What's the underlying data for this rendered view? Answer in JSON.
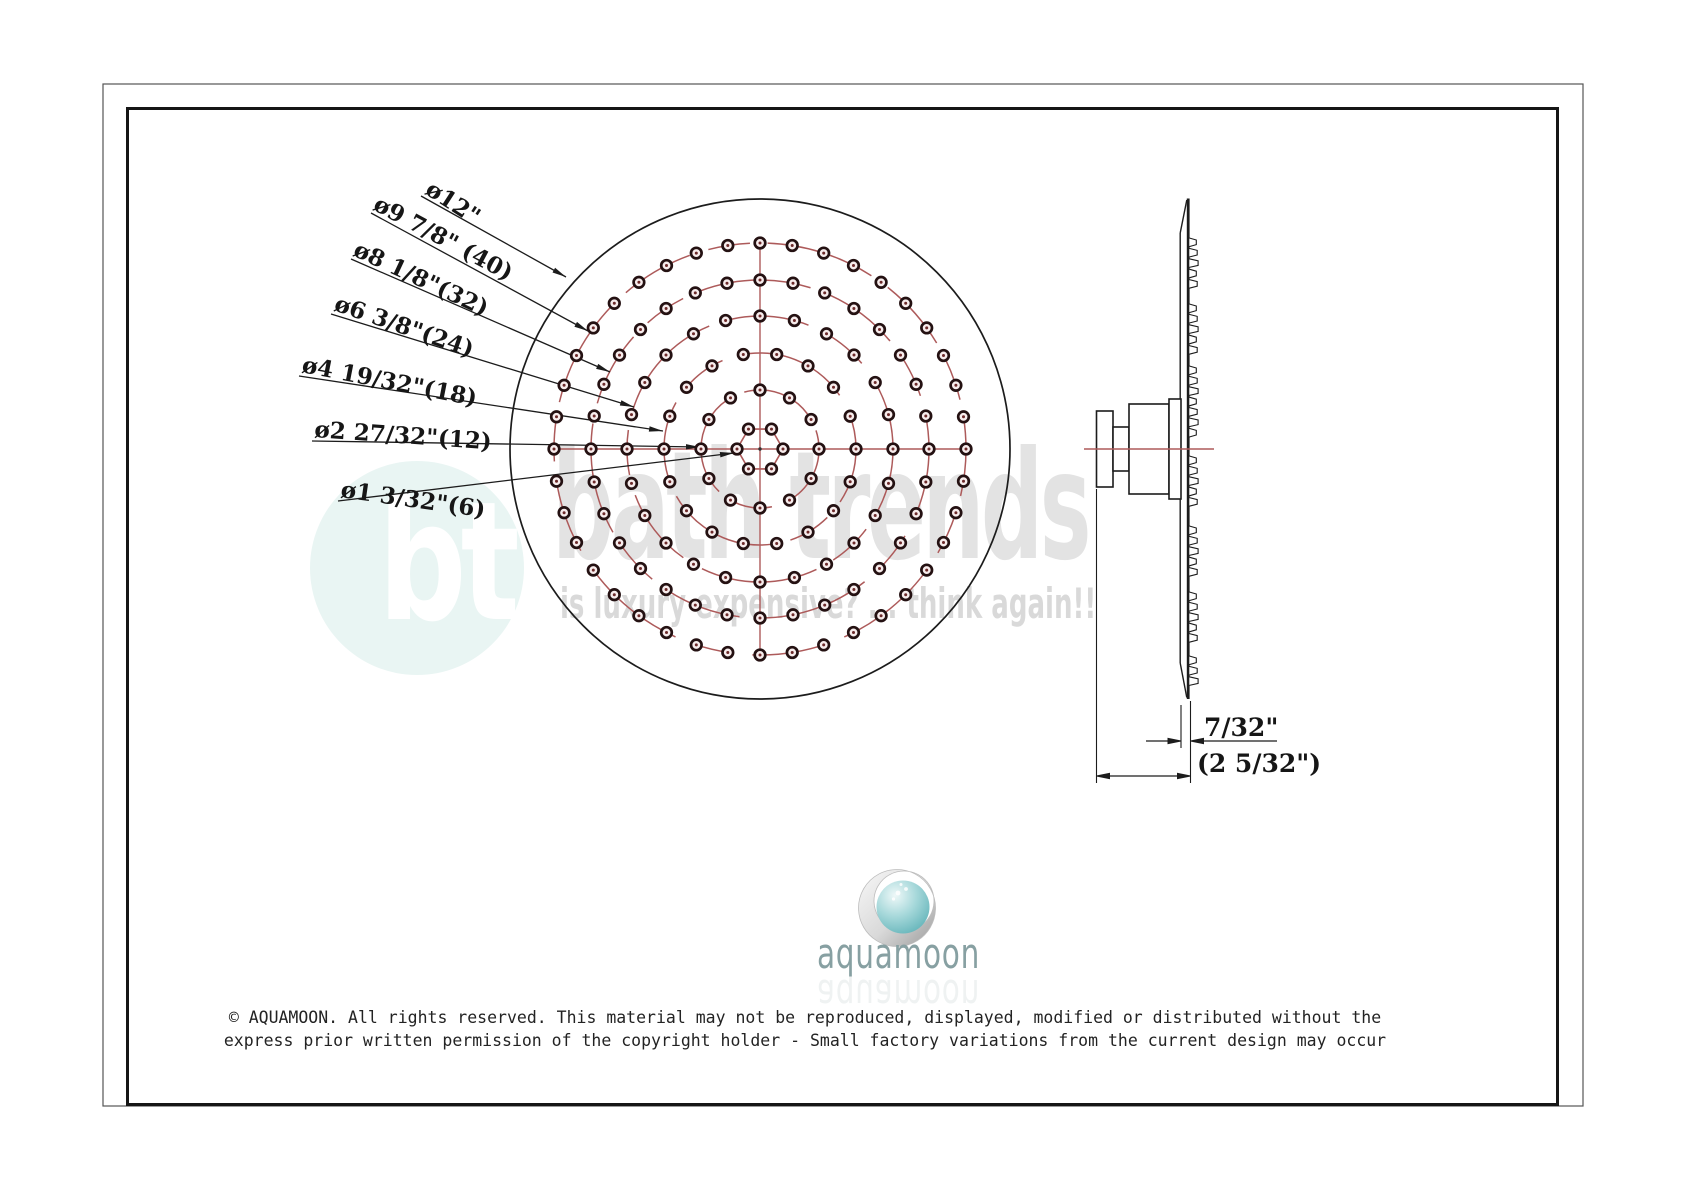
{
  "front_view": {
    "center": {
      "x": 760,
      "y": 449
    },
    "outer_circle": {
      "radius_px": 250,
      "diameter_label": "ø12\""
    },
    "rings": [
      {
        "nozzle_count": 6,
        "radius_px": 23,
        "diameter_label": "ø1 3/32\"",
        "shape": "hexagon"
      },
      {
        "nozzle_count": 12,
        "radius_px": 59,
        "diameter_label": "ø2 27/32\"",
        "shape": "circle"
      },
      {
        "nozzle_count": 18,
        "radius_px": 96,
        "diameter_label": "ø4 19/32\"",
        "shape": "circle"
      },
      {
        "nozzle_count": 24,
        "radius_px": 133,
        "diameter_label": "ø6 3/8\"",
        "shape": "circle"
      },
      {
        "nozzle_count": 32,
        "radius_px": 169,
        "diameter_label": "ø8 1/8\"",
        "shape": "circle"
      },
      {
        "nozzle_count": 40,
        "radius_px": 206,
        "diameter_label": "ø9 7/8\"",
        "shape": "circle"
      }
    ],
    "callouts": [
      {
        "text": "ø12\"",
        "leader": [
          421,
          196,
          566,
          277
        ]
      },
      {
        "text": "ø9 7/8\" (40)",
        "leader": [
          371,
          213,
          588,
          331
        ]
      },
      {
        "text": "ø8 1/8\"(32)",
        "leader": [
          351,
          259,
          610,
          372
        ]
      },
      {
        "text": "ø6 3/8\"(24)",
        "leader": [
          331,
          314,
          634,
          407
        ]
      },
      {
        "text": "ø4 19/32\"(18)",
        "leader": [
          299,
          376,
          663,
          431
        ]
      },
      {
        "text": "ø2 27/32\"(12)",
        "leader": [
          312,
          441,
          700,
          447
        ]
      },
      {
        "text": "ø1 3/32\"(6)",
        "leader": [
          338,
          501,
          734,
          453
        ]
      }
    ]
  },
  "side_view": {
    "thickness_label": "7/32\"",
    "depth_label": "(2 5/32\")"
  },
  "watermark": {
    "monogram": "bt",
    "brand": "bath trends",
    "tagline": "is luxury expensive? ... think again!!"
  },
  "logo": {
    "text": "aquamoon"
  },
  "footer": {
    "line1": "© AQUAMOON. All rights reserved. This material may not be reproduced, displayed, modified or distributed without the",
    "line2": "express prior written permission of the copyright holder - Small factory variations from the current design may occur"
  },
  "colors": {
    "line": "#1c1c1c",
    "accent_red": "#ad5a5a",
    "nozzle_ring": "#241112",
    "nozzle_dot": "#6d2a2a",
    "watermark_teal": "#e9f5f3",
    "watermark_gray": "#e3e3e3",
    "logo_text": "#87a0a2"
  }
}
